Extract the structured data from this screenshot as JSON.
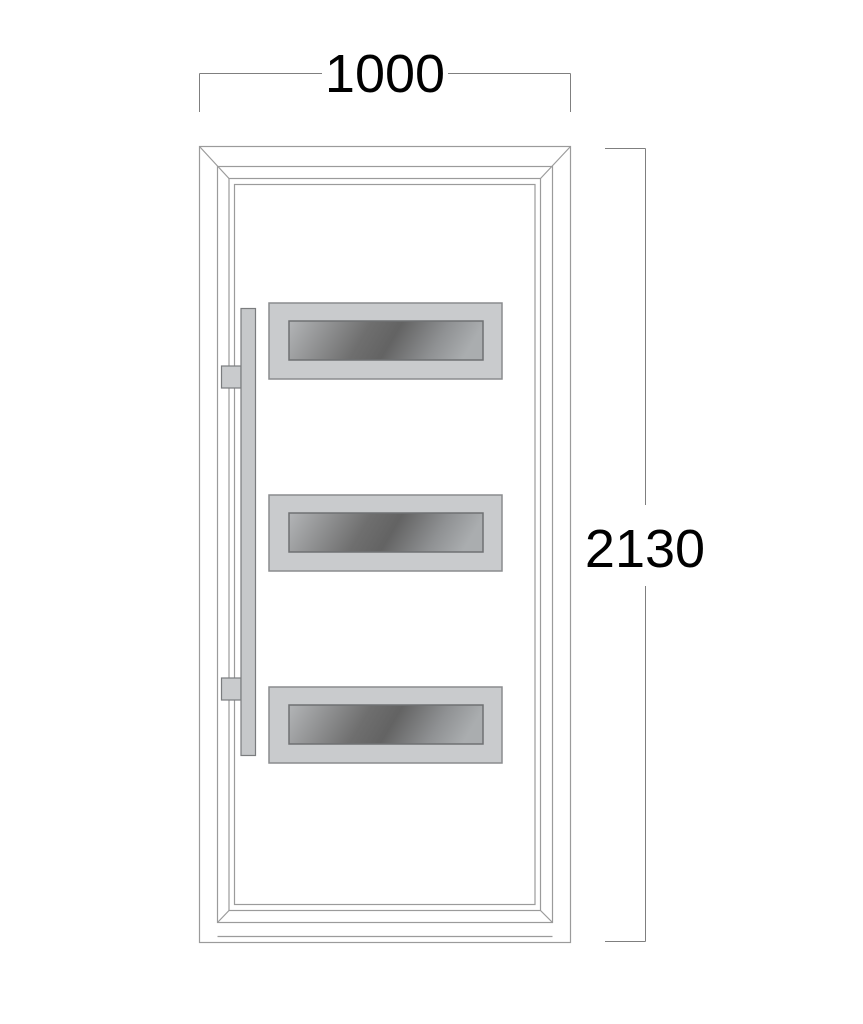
{
  "drawing": {
    "type": "door-elevation-technical-drawing",
    "dimensions": {
      "width": {
        "value": "1000"
      },
      "height": {
        "value": "2130"
      }
    },
    "door": {
      "glass_panel_count": 3,
      "handle_side": "left",
      "handle_mount_count": 2
    },
    "colors": {
      "background": "#ffffff",
      "frame_line": "#9b9b9b",
      "dimension_line": "#7f7f7f",
      "dimension_text": "#000000",
      "panel_frame_fill": "#c9cbcd",
      "panel_frame_stroke": "#8a8c8e",
      "glass_light": "#b3b5b7",
      "glass_dark": "#636363",
      "handle_fill": "#c6c8ca",
      "handle_stroke": "#7a7c7e"
    }
  }
}
